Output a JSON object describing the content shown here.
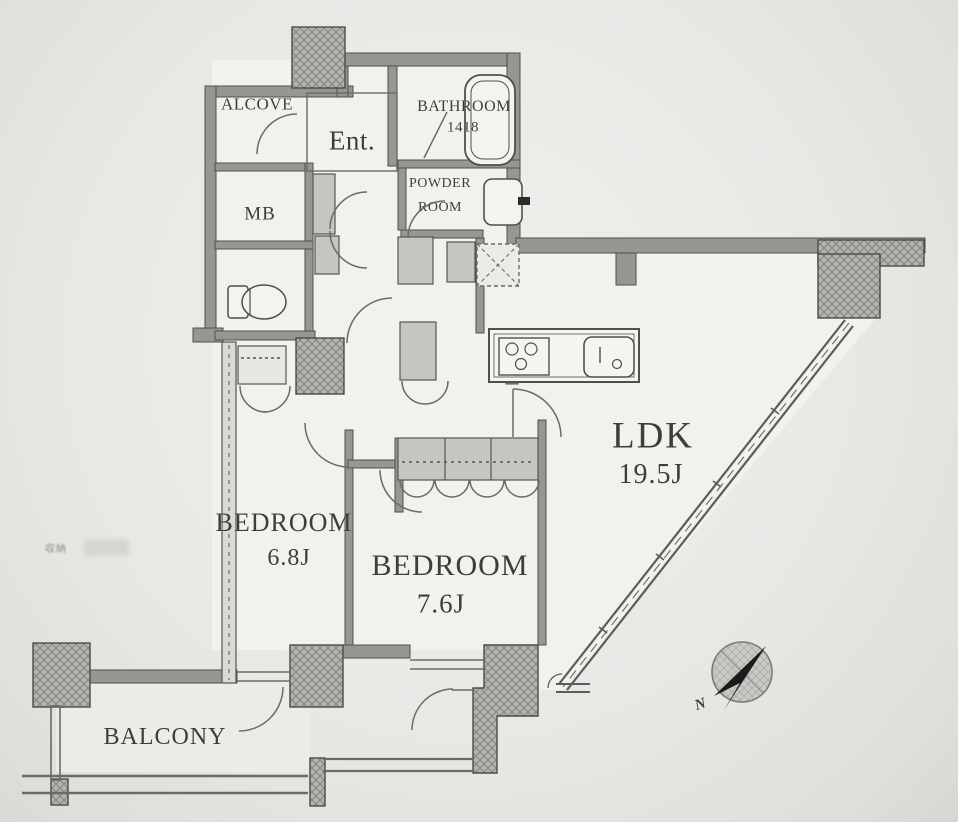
{
  "document": {
    "kind": "apartment-floor-plan",
    "layout_type": "2LDK"
  },
  "rooms": {
    "alcove": {
      "label": "ALCOVE"
    },
    "entrance": {
      "label": "Ent."
    },
    "bathroom": {
      "label": "BATHROOM",
      "size_code": "1418"
    },
    "powder_room": {
      "line1": "POWDER",
      "line2": "ROOM"
    },
    "meter_box": {
      "label": "MB"
    },
    "ldk": {
      "label": "LDK",
      "area": "19.5J"
    },
    "bedroom_left": {
      "label": "BEDROOM",
      "area": "6.8J"
    },
    "bedroom_center": {
      "label": "BEDROOM",
      "area": "7.6J"
    },
    "balcony": {
      "label": "BALCONY"
    }
  },
  "compass": {
    "north_label": "N"
  },
  "watermark": {
    "text": "収納"
  },
  "colors": {
    "background": "#eae8e5",
    "wall_fill": "#98969ptr3",
    "wall": "#989693",
    "wall_outline": "#504f4c",
    "hatch_fill": "#b5b3b0",
    "thin_line": "#636260",
    "closet_fill": "#c7c5c2",
    "text": "#3e3d3a",
    "compass_arrow": "#1b1b1b"
  }
}
